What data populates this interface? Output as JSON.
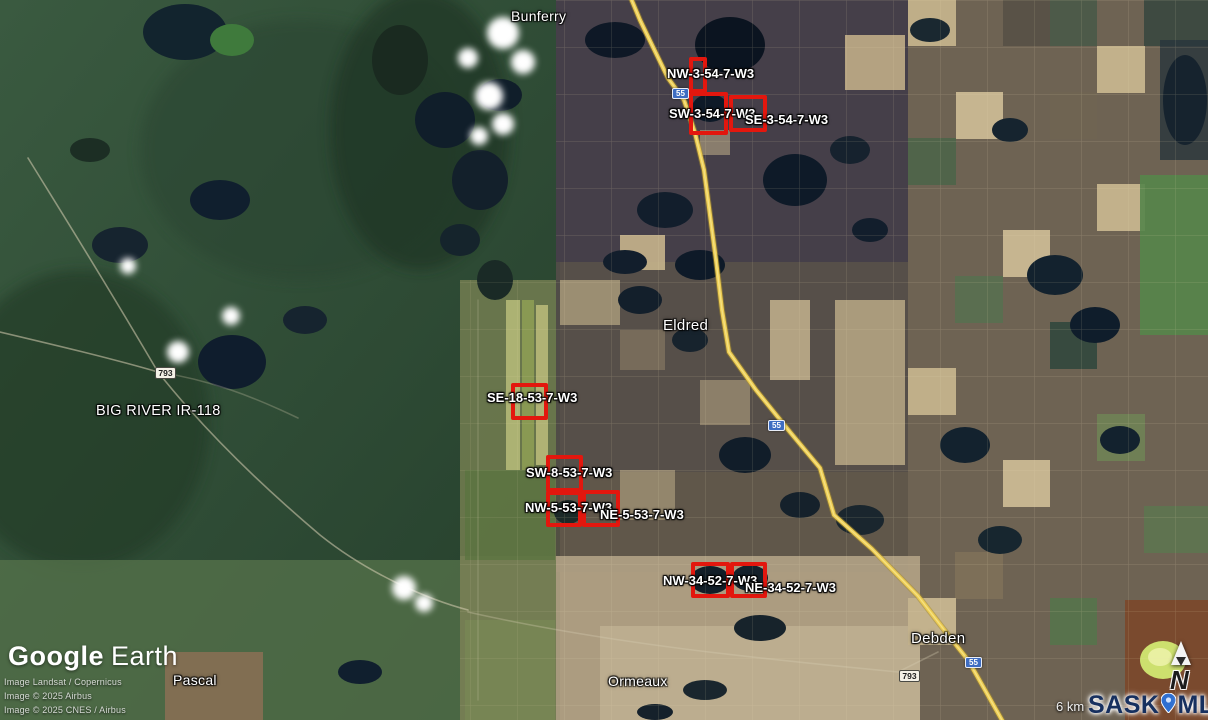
{
  "app": {
    "name": "Google Earth"
  },
  "attribution": {
    "logo_primary": "Google",
    "logo_secondary": "Earth",
    "lines": [
      "Image Landsat / Copernicus",
      "Image © 2025 Airbus",
      "Image © 2025 CNES / Airbus"
    ]
  },
  "scale_bar": {
    "label": "6 km"
  },
  "watermark": {
    "prefix": "SASK",
    "suffix": "MLS",
    "registered": "®"
  },
  "compass": {
    "north_label": "N"
  },
  "places": [
    {
      "name": "Bunferry"
    },
    {
      "name": "Eldred"
    },
    {
      "name": "BIG RIVER IR-118"
    },
    {
      "name": "Debden"
    },
    {
      "name": "Ormeaux"
    },
    {
      "name": "Pascal"
    }
  ],
  "highways": [
    {
      "label": "55"
    },
    {
      "label": "793"
    }
  ],
  "parcels": [
    {
      "label": "NW-3-54-7-W3"
    },
    {
      "label": "SW-3-54-7-W3"
    },
    {
      "label": "SE-3-54-7-W3"
    },
    {
      "label": "SE-18-53-7-W3"
    },
    {
      "label": "SW-8-53-7-W3"
    },
    {
      "label": "NW-5-53-7-W3"
    },
    {
      "label": "NE-5-53-7-W3"
    },
    {
      "label": "NW-34-52-7-W3"
    },
    {
      "label": "NE-34-52-7-W3"
    }
  ],
  "colors": {
    "parcel_outline": "#e3170e",
    "highway_line": "#eccb52",
    "provincial_shield": "#3e6dc2",
    "watermark_text": "#17305f"
  }
}
